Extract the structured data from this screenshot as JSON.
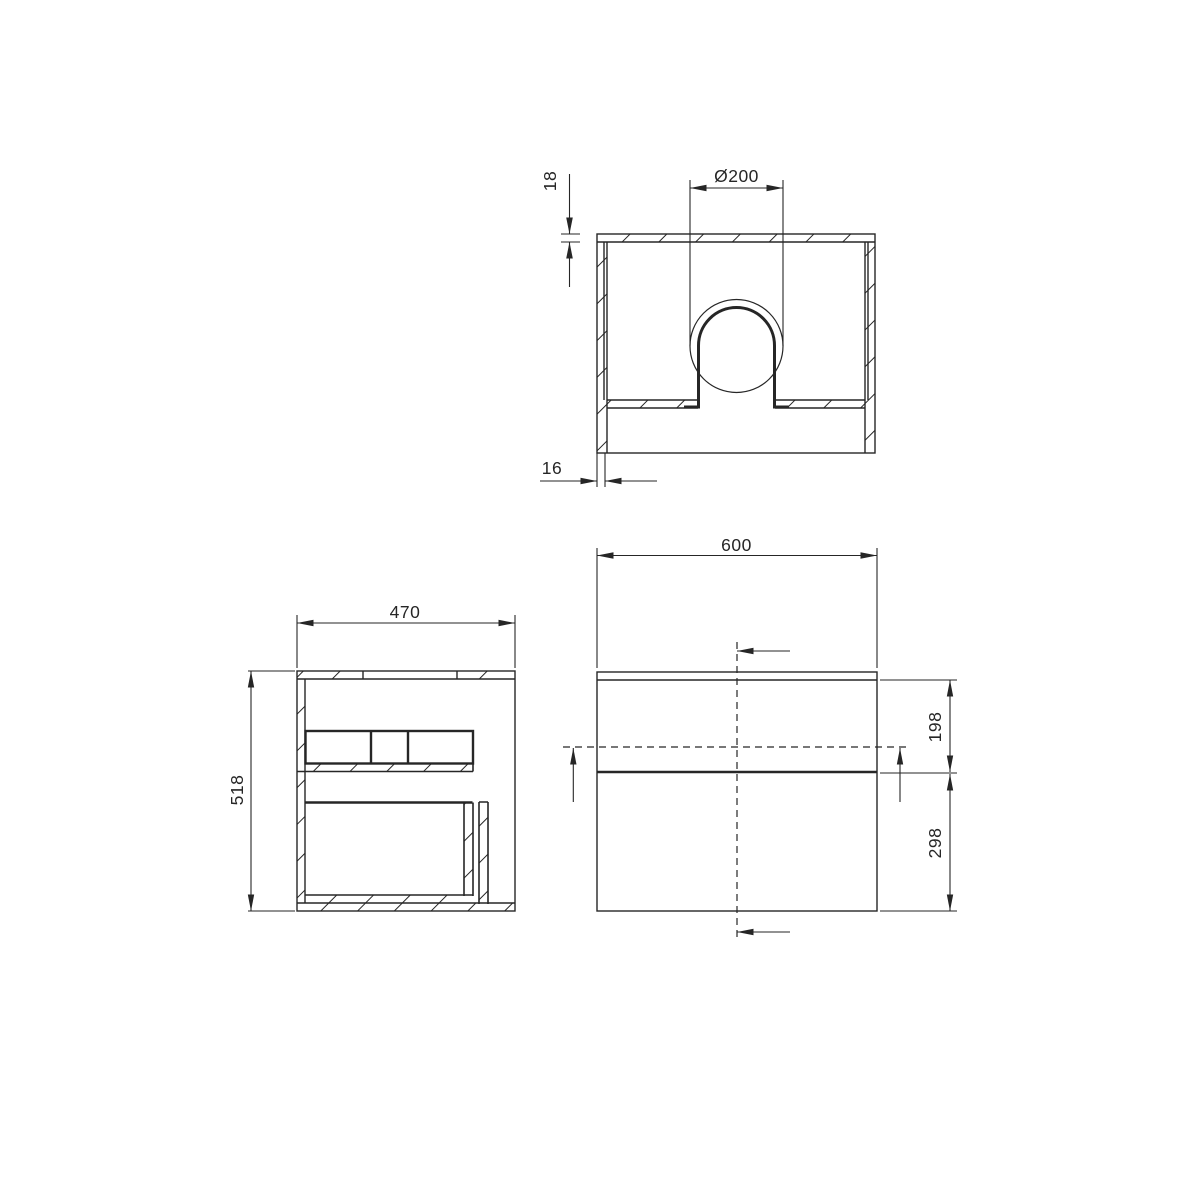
{
  "drawing": {
    "background": "#ffffff",
    "line_color": "#262626",
    "dimensions": {
      "countertop_thickness": "18",
      "hole_diameter": "Ø200",
      "side_panel_thickness": "16",
      "depth": "470",
      "body_height": "518",
      "width": "600",
      "upper_drawer_front": "198",
      "lower_drawer_front": "298"
    }
  }
}
